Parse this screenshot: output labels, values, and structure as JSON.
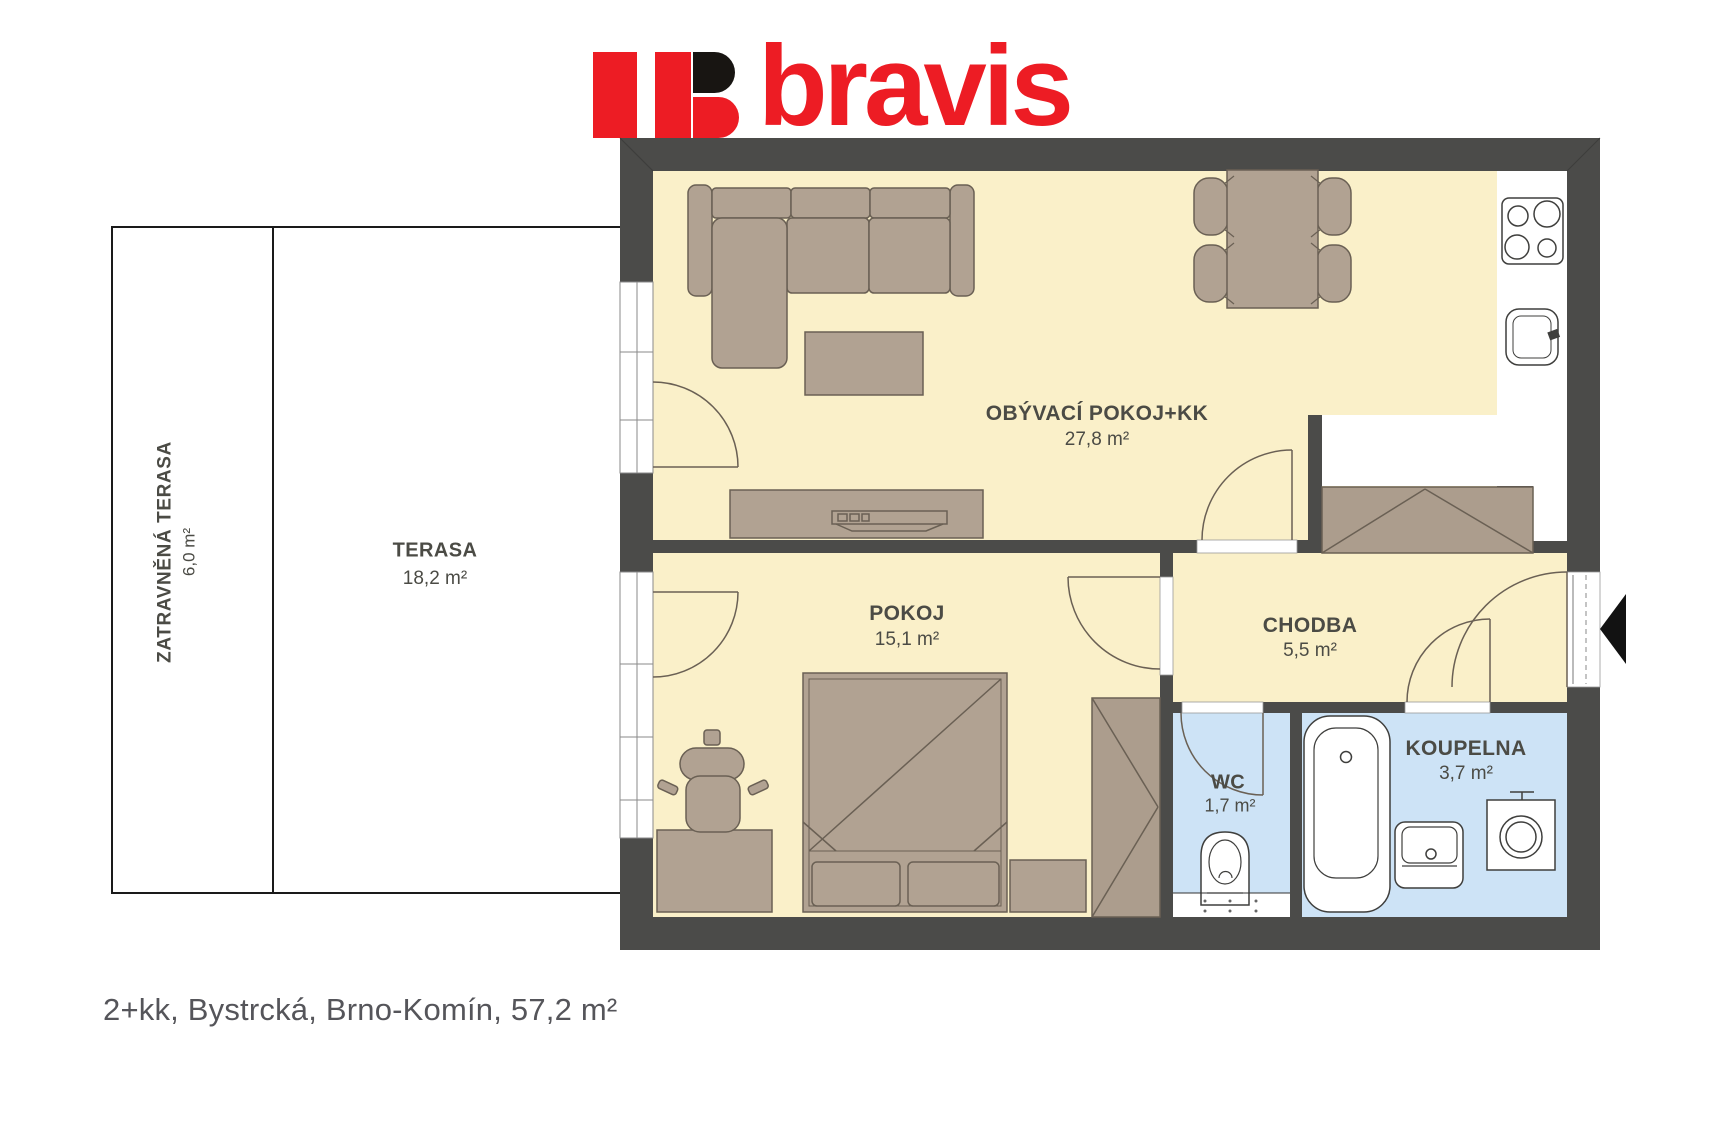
{
  "brand": {
    "name": "bravis"
  },
  "plan": {
    "rooms": {
      "living": {
        "label": "OBÝVACÍ POKOJ+KK",
        "area": "27,8 m²"
      },
      "bedroom": {
        "label": "POKOJ",
        "area": "15,1 m²"
      },
      "hall": {
        "label": "CHODBA",
        "area": "5,5 m²"
      },
      "wc": {
        "label": "WC",
        "area": "1,7 m²"
      },
      "bathroom": {
        "label": "KOUPELNA",
        "area": "3,7 m²"
      },
      "terrace": {
        "label": "TERASA",
        "area": "18,2 m²"
      },
      "grass_terrace": {
        "label": "ZATRAVNĚNÁ TERASA",
        "area": "6,0 m²"
      }
    }
  },
  "caption": "2+kk, Bystrcká, Brno-Komín, 57,2 m²",
  "colors": {
    "accent_red": "#ED1C24",
    "wall": "#4B4B49",
    "floor_yellow": "#FAF0C9",
    "floor_blue": "#CDE3F6",
    "furniture": "#B1A292",
    "wardrobe": "#AC9D8D",
    "outline": "#6A6054",
    "label_text": "#4B4B45"
  }
}
